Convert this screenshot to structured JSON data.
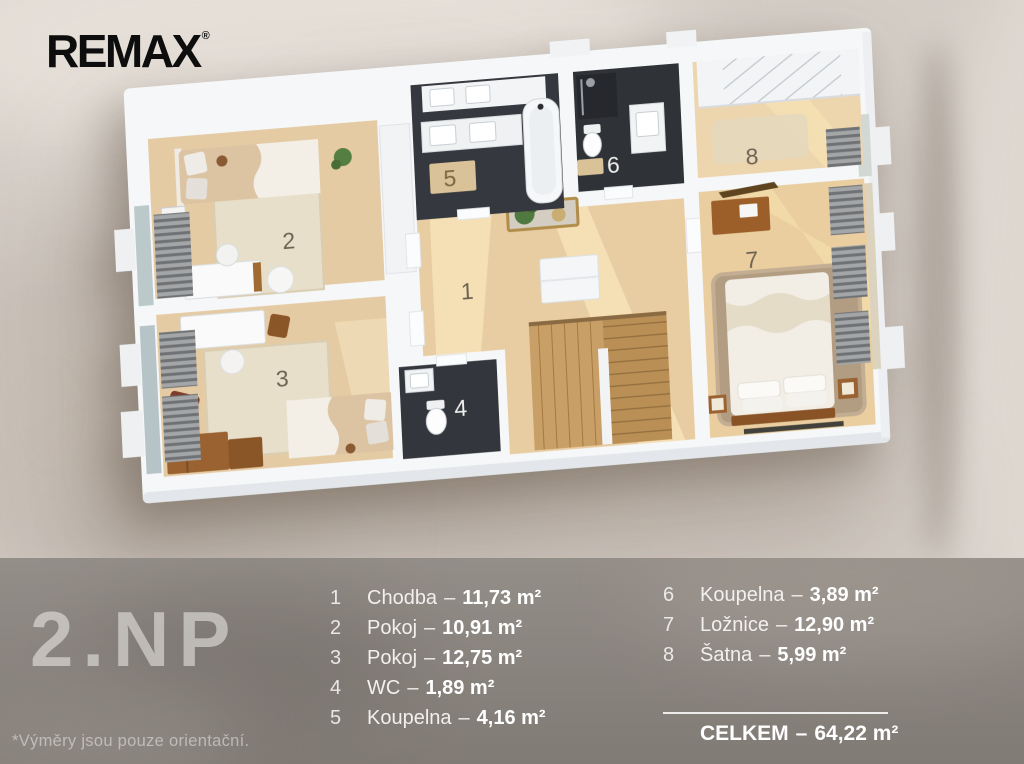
{
  "brand": {
    "name": "REMAX",
    "registered": "®"
  },
  "floor": {
    "title": "2.NP",
    "footnote": "*Výměry jsou pouze orientační."
  },
  "legend": {
    "separator": "–",
    "columns": [
      {
        "items": [
          {
            "num": "1",
            "name": "Chodba",
            "area": "11,73 m²"
          },
          {
            "num": "2",
            "name": "Pokoj",
            "area": "10,91 m²"
          },
          {
            "num": "3",
            "name": "Pokoj",
            "area": "12,75 m²"
          },
          {
            "num": "4",
            "name": "WC",
            "area": "1,89 m²"
          },
          {
            "num": "5",
            "name": "Koupelna",
            "area": "4,16 m²"
          }
        ]
      },
      {
        "items": [
          {
            "num": "6",
            "name": "Koupelna",
            "area": "3,89 m²"
          },
          {
            "num": "7",
            "name": "Ložnice",
            "area": "12,90 m²"
          },
          {
            "num": "8",
            "name": "Šatna",
            "area": "5,99 m²"
          }
        ]
      }
    ],
    "total": {
      "label": "CELKEM",
      "area": "64,22 m²"
    }
  },
  "plan": {
    "room_numbers": [
      "1",
      "2",
      "3",
      "4",
      "5",
      "6",
      "7",
      "8"
    ]
  },
  "colors": {
    "page_bg": "#d4cdc6",
    "panel_bg": "#8b8580",
    "text_light": "#f4f2ef",
    "logo_black": "#0d0d0d",
    "wall_white": "#f6f7f8",
    "tile_dark": "#35383e",
    "wood_floor": "#e8cda3",
    "wood_sun": "#f8e5ba",
    "carpet": "#e5cba4",
    "rug_cream": "#e8dfca",
    "rug_brown": "#b39d82",
    "wood_furniture": "#9a6231"
  }
}
